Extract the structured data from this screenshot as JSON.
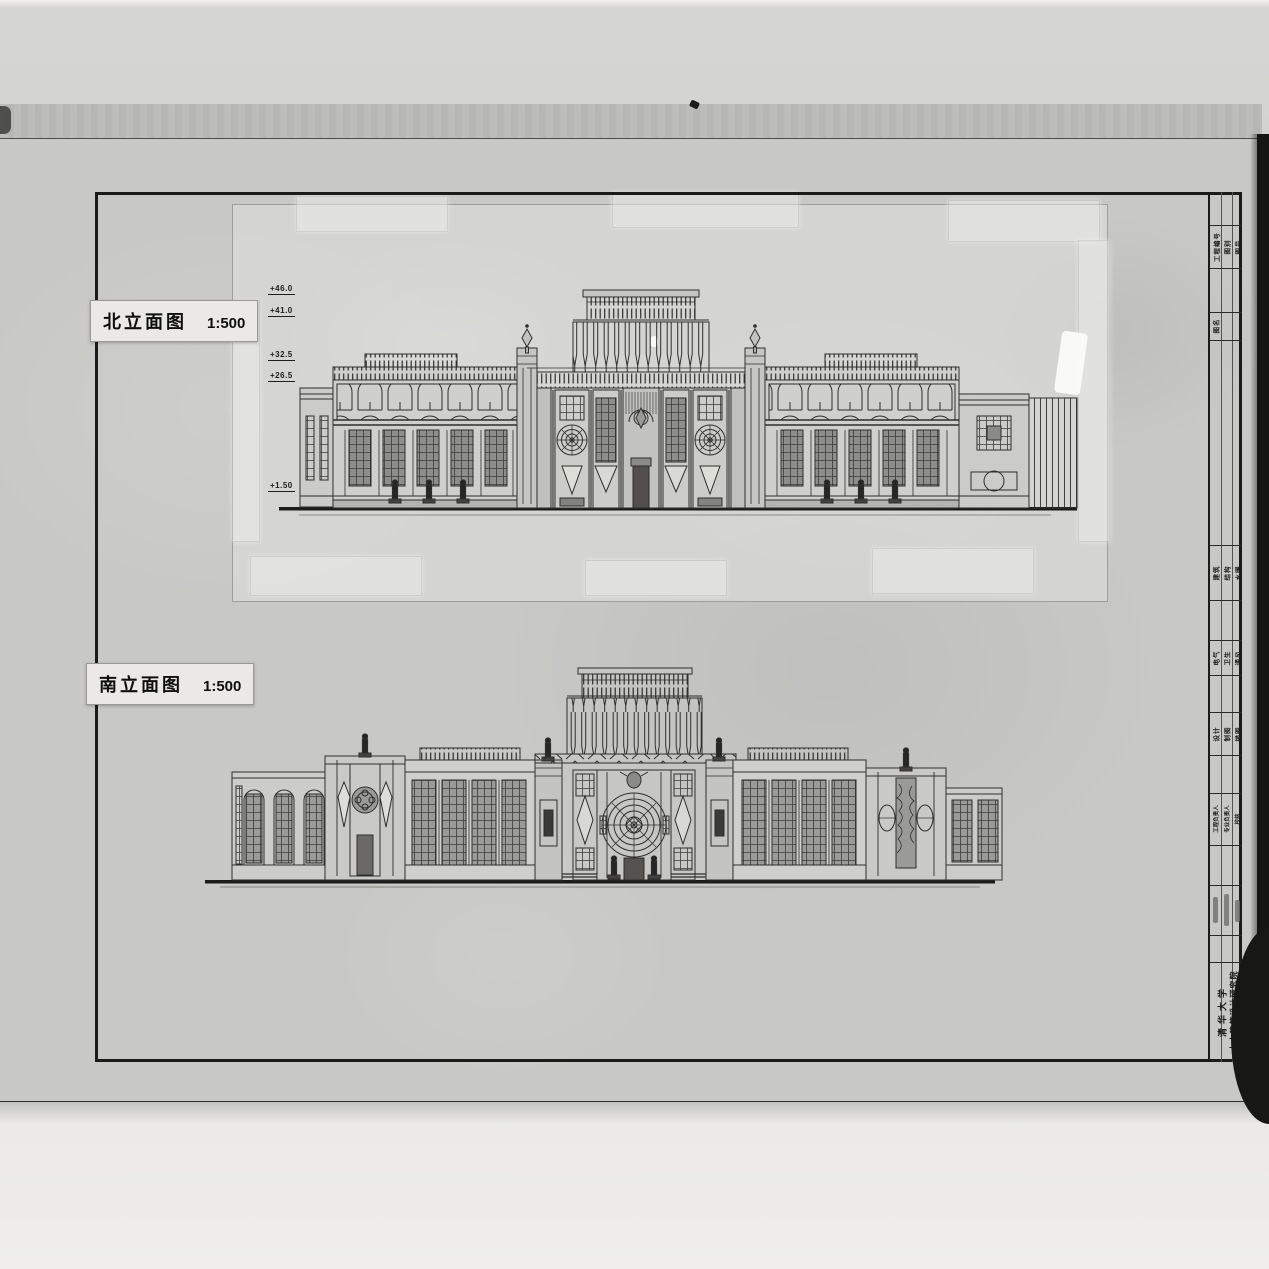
{
  "labels": {
    "north": {
      "title": "北立面图",
      "scale": "1:500"
    },
    "south": {
      "title": "南立面图",
      "scale": "1:500"
    }
  },
  "north_elevation": {
    "level_markers": [
      "+46.0",
      "+41.0",
      "+32.5",
      "+26.5",
      "+1.50"
    ]
  },
  "title_block": {
    "row_top": [
      "工程编号",
      "图别",
      "图号"
    ],
    "row_drawing_name": "图名",
    "row_specialty_1": [
      "建筑",
      "结构",
      "水暖"
    ],
    "row_specialty_2": [
      "电气",
      "卫生",
      "通风"
    ],
    "row_roles_1": [
      "设计",
      "制图",
      "描图"
    ],
    "row_roles_2": [
      "工程负责人",
      "专业负责人",
      "校核"
    ],
    "institution": {
      "line1": "清华大学",
      "line2": "土木建筑设计研究院"
    }
  },
  "colors": {
    "sheet": "#c8c8c5",
    "patch": "#d8d8d4",
    "ink": "#2e2e2c",
    "label_bg": "#eae9e5",
    "film_edge": "#151513"
  }
}
